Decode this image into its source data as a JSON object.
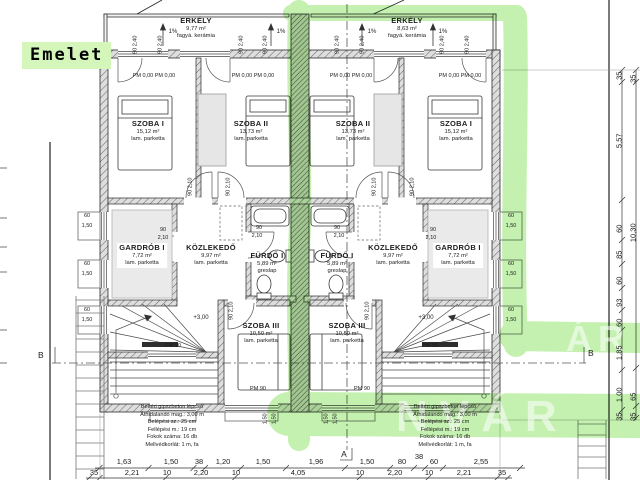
{
  "page": {
    "label": "Emelet"
  },
  "watermark": {
    "main": "NVÁR",
    "upper": "ÁR"
  },
  "rooms": {
    "erkely_left": {
      "name": "ERKÉLY",
      "area": "9,77 m²",
      "finish": "fagyá. kerámia"
    },
    "erkely_right": {
      "name": "ERKÉLY",
      "area": "8,63 m²",
      "finish": "fagyá. kerámia"
    },
    "szoba1": {
      "name": "SZOBA I",
      "area": "15,12 m²",
      "finish": "lam. parketta"
    },
    "szoba2": {
      "name": "SZOBA II",
      "area": "13,73 m²",
      "finish": "lam. parketta"
    },
    "szoba3": {
      "name": "SZOBA III",
      "area": "10,50 m²",
      "finish": "lam. parketta"
    },
    "gardrob": {
      "name": "GARDRÓB I",
      "area": "7,72 m²",
      "finish": "lam. parketta"
    },
    "kozlekedo": {
      "name": "KÖZLEKEDŐ",
      "area": "9,97 m²",
      "finish": "lam. parketta"
    },
    "furdo": {
      "name": "FÜRDŐ I",
      "area": "5,89 m²",
      "finish": "greslap"
    }
  },
  "stair_note": {
    "l1": "Beltéri gipszbeton lépcső",
    "l2": "Áthidalandó mag.: 3,00 m",
    "l3": "Belépési sz.: 25 cm",
    "l4": "Fellépési m.: 19 cm",
    "l5": "Fokok száma: 16 db",
    "l6": "Mellvédkorlát: 1 m, fa"
  },
  "labels": {
    "slope": "1%",
    "pm_000": "PM 0,00 PM 0,00",
    "pm_90": "PM 90",
    "level": "+3,00",
    "w90": "90",
    "h210": "2,10",
    "w60": "60",
    "h150": "1,50",
    "sill_90_240": "90  2,40",
    "door_90_210": "90  2,10",
    "section_a": "A",
    "section_b": "B"
  },
  "dims": {
    "bottom_row1": [
      "1,63",
      "1,50",
      "38",
      "1,20",
      "1,50",
      "1,96",
      "1,50",
      "80",
      "38",
      "60",
      "2,55"
    ],
    "bottom_row2": [
      "35",
      "2,21",
      "10",
      "2,20",
      "10",
      "4,05",
      "10",
      "2,20",
      "10",
      "2,21",
      "35"
    ],
    "right_col": [
      "35",
      "35",
      "5,57",
      "60",
      "10,30",
      "85",
      "60",
      "93",
      "60",
      "1,85",
      "11,30",
      "1,00",
      "65",
      "35",
      "35"
    ]
  }
}
